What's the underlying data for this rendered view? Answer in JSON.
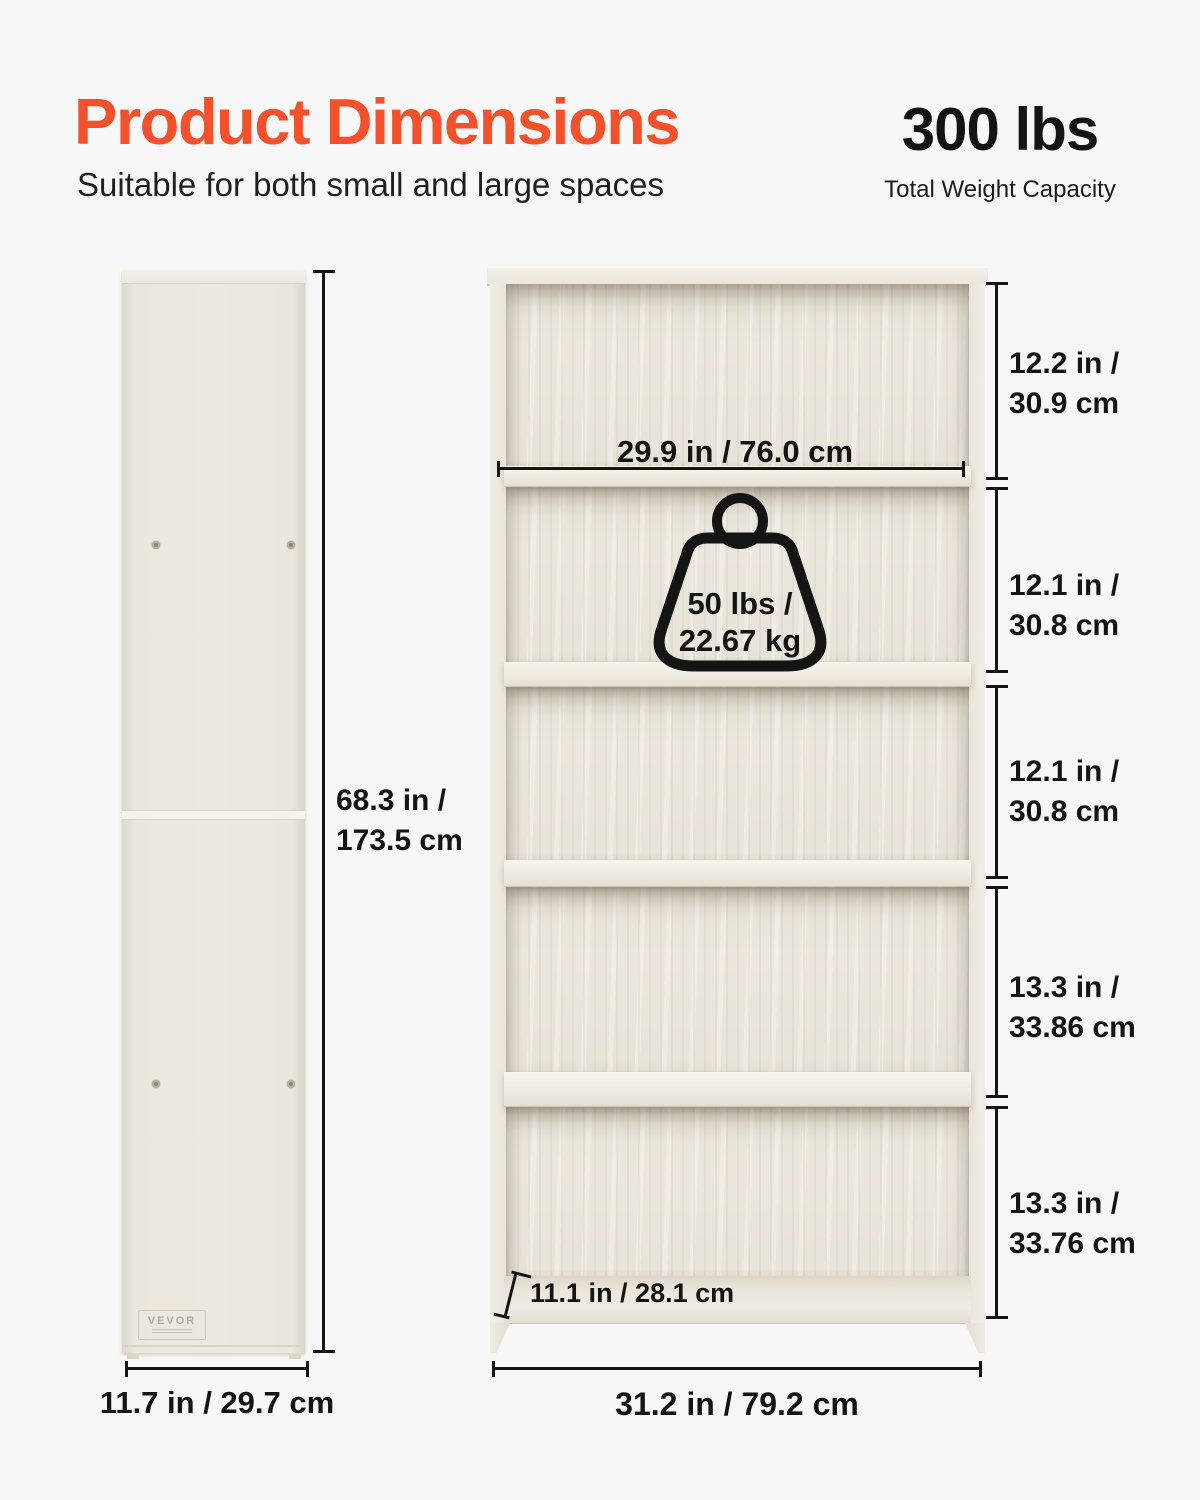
{
  "header": {
    "title": "Product Dimensions",
    "subtitle": "Suitable for both small and large spaces",
    "capacity_value": "300 lbs",
    "capacity_label": "Total Weight Capacity"
  },
  "colors": {
    "accent": "#f4502b",
    "text": "#141414",
    "background": "#f7f7f7",
    "wood_light": "#f0ece3",
    "wood_back": "#e9e4d9",
    "dimension_line": "#151515"
  },
  "side_view": {
    "brand": "VEVOR",
    "height": {
      "line1": "68.3 in /",
      "line2": "173.5 cm"
    },
    "width": "11.7 in / 29.7 cm"
  },
  "front_view": {
    "shelf_width": "29.9 in / 76.0 cm",
    "shelf_capacity": {
      "line1": "50 lbs /",
      "line2": "22.67 kg"
    },
    "depth": "11.1 in / 28.1 cm",
    "overall_width": "31.2 in / 79.2 cm",
    "compartments": [
      {
        "line1": "12.2 in /",
        "line2": "30.9 cm"
      },
      {
        "line1": "12.1 in /",
        "line2": "30.8 cm"
      },
      {
        "line1": "12.1 in /",
        "line2": "30.8 cm"
      },
      {
        "line1": "13.3 in /",
        "line2": "33.86 cm"
      },
      {
        "line1": "13.3 in /",
        "line2": "33.76 cm"
      }
    ]
  }
}
